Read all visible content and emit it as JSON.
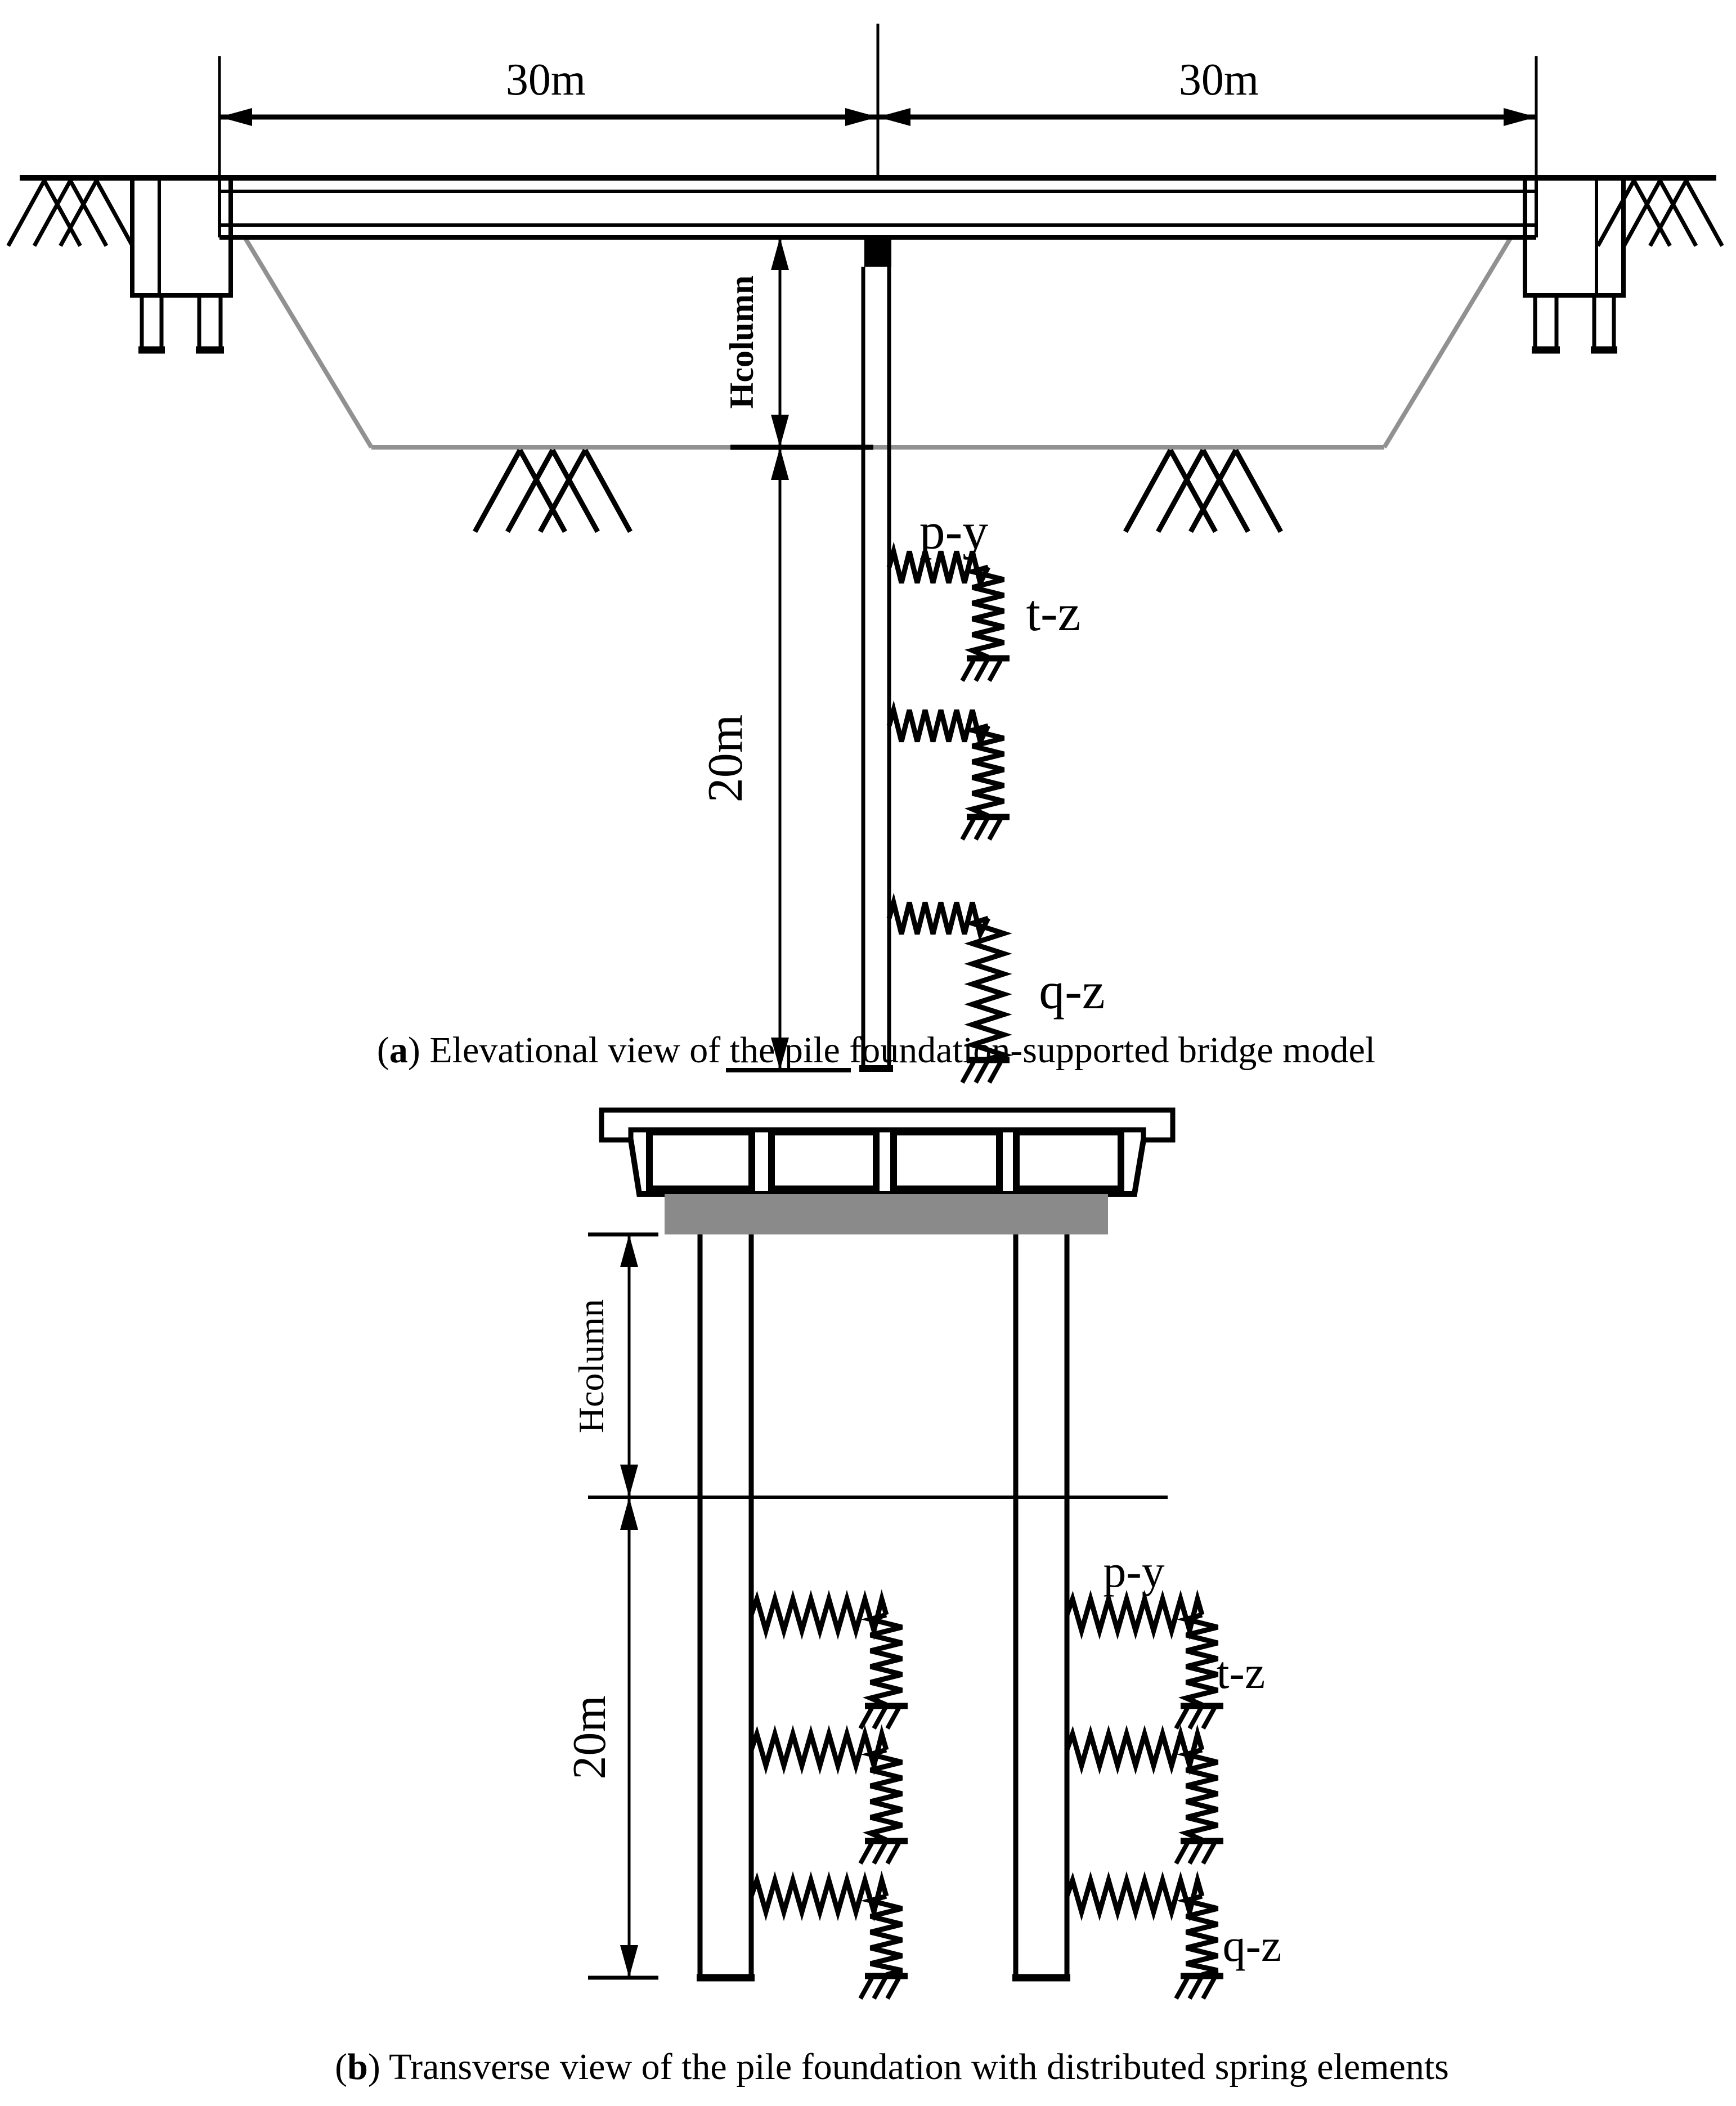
{
  "figure": {
    "panel_a": {
      "caption": {
        "open": "(",
        "letter": "a",
        "rest": ") Elevational view of the pile foundation-supported bridge model"
      },
      "dim_span_left": "30m",
      "dim_span_right": "30m",
      "dim_column_height": "Hcolumn",
      "dim_pile_length": "20m",
      "spring_lateral": "p-y",
      "spring_shaft": "t-z",
      "spring_tip": "q-z"
    },
    "panel_b": {
      "caption": {
        "open": "(",
        "letter": "b",
        "rest": ") Transverse view of the pile foundation with distributed spring elements"
      },
      "dim_column_height": "Hcolumn",
      "dim_pile_length": "20m",
      "spring_lateral": "p-y",
      "spring_shaft": "t-z",
      "spring_tip": "q-z"
    },
    "colors": {
      "ink": "#000000",
      "cap_gray": "#8a8a8a",
      "ground_gray": "#919191",
      "background": "#ffffff"
    }
  }
}
